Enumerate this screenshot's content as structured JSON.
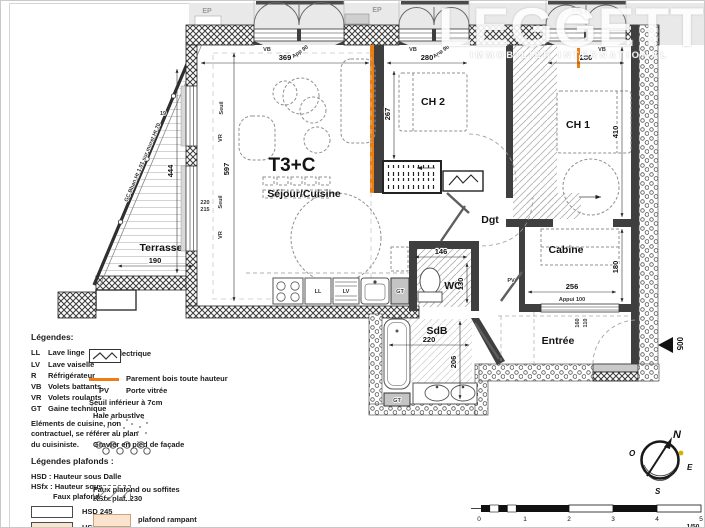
{
  "watermark": {
    "brand": "LEGGETT",
    "tagline": "IMMOBILIER INTERNATIONAL"
  },
  "plan": {
    "unit_label": "T3+C",
    "rooms": {
      "sejour": "Séjour/Cuisine",
      "ch2": "CH 2",
      "ch1": "CH 1",
      "cabine": "Cabine",
      "wc": "WC",
      "sdb": "SdB",
      "entree": "Entrée",
      "terrasse": "Terrasse",
      "dgt": "Dgt"
    },
    "dims": {
      "sejour_w": "369",
      "sejour_h": "597",
      "ch2_w": "280",
      "ch2_h": "267",
      "ch1_w": "280",
      "ch1_h": "410",
      "terrasse_h": "444",
      "terrasse_w": "190",
      "sill_a": "220",
      "sill_b": "215",
      "sill_c": "19",
      "wc_w": "146",
      "wc_h": "130",
      "cabine_w": "256",
      "cabine_appui": "Appui 100",
      "cabine_h": "180",
      "sdb_w": "220",
      "sdb_h": "206",
      "entree_a": "160",
      "entree_b": "110"
    },
    "tags": {
      "ll": "LL",
      "lv": "LV",
      "gt": "GT",
      "r": "R",
      "pv": "PV",
      "vb": "VB",
      "vr": "VR",
      "seuil": "Seuil",
      "ep": "EP",
      "app90": "App 90",
      "railing": "GC Bban Ht 1.01 sur muret Ht 70",
      "marker": "005"
    }
  },
  "legend": {
    "left": {
      "title": "Légendes:",
      "items": [
        {
          "abbr": "LL",
          "label": "Lave linge"
        },
        {
          "abbr": "LV",
          "label": "Lave vaiselle"
        },
        {
          "abbr": "R",
          "label": "Réfrigérateur"
        },
        {
          "abbr": "VB",
          "label": "Volets battants"
        },
        {
          "abbr": "VR",
          "label": "Volets roulants"
        },
        {
          "abbr": "GT",
          "label": "Gaine technique"
        }
      ],
      "note": "Eléments de cuisine, non contractuel, se référer au plan du cuisiniste.",
      "plafonds_title": "Légendes plafonds :",
      "hsd_def": "HSD : Hauteur sous Dalle",
      "hsfx_def1": "HSfx : Hauteur sous",
      "hsfx_def2": "Faux plafond",
      "swatch_245": "HSD 245",
      "swatch_243": "HSD 243"
    },
    "right": {
      "coffret": "Coffret électrique",
      "parement": "Parement bois toute hauteur",
      "pv_abbr": "PV",
      "pv_label": "Porte vitrée",
      "seuil_note": "Seuil inférieur à 7cm",
      "haie": "Haie arbustive",
      "gravier": "Gravier en pied de façade",
      "faux_line1": "Faux plafond ou soffites",
      "faux_line2": "HSfx plaf. 230",
      "rampant": "plafond rampant"
    }
  },
  "compass": {
    "n": "N",
    "s": "S",
    "e": "E",
    "o": "O"
  },
  "scale": {
    "ticks": [
      "0",
      "1",
      "2",
      "3",
      "4",
      "5"
    ],
    "ratio": "1/50"
  },
  "colors": {
    "accent_orange": "#ee7d11",
    "ceiling_peach": "#fbe3cd",
    "wall": "#3f3f3f",
    "outside_grey": "#e9e9e9"
  }
}
